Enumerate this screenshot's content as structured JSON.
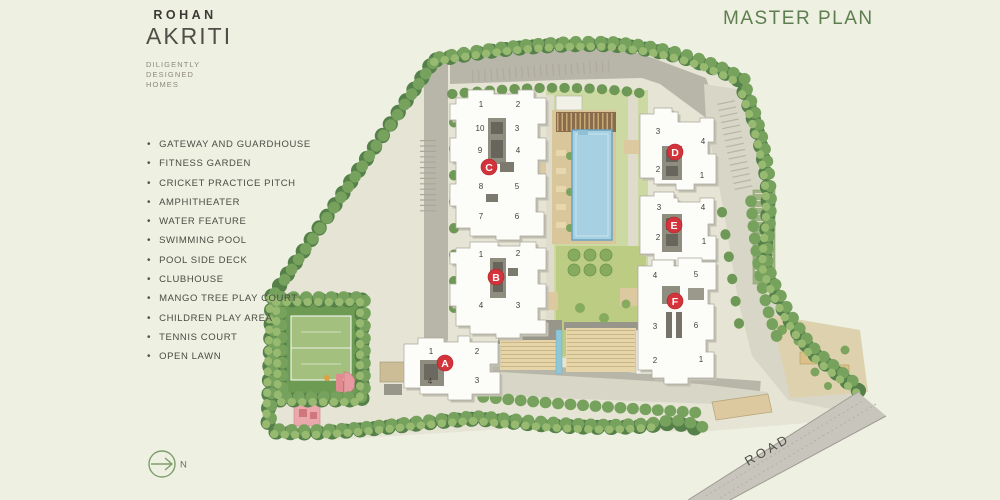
{
  "brand": {
    "name": "ROHAN",
    "product": "AKRITI",
    "tagline_line1": "DILIGENTLY",
    "tagline_line2": "DESIGNED HOMES"
  },
  "header": {
    "title": "MASTER PLAN"
  },
  "amenities": {
    "items": [
      "GATEWAY AND GUARDHOUSE",
      "FITNESS GARDEN",
      "CRICKET PRACTICE PITCH",
      "AMPHITHEATER",
      "WATER FEATURE",
      "SWIMMING POOL",
      "POOL SIDE DECK",
      "CLUBHOUSE",
      "MANGO TREE PLAY COURT",
      "CHILDREN PLAY AREA",
      "TENNIS COURT",
      "OPEN LAWN"
    ]
  },
  "compass": {
    "north_label": "N"
  },
  "site_plan": {
    "road_label": "ROAD",
    "towers": [
      {
        "id": "A",
        "units": [
          "1",
          "2",
          "4",
          "3"
        ]
      },
      {
        "id": "B",
        "units": [
          "1",
          "2",
          "4",
          "3"
        ]
      },
      {
        "id": "C",
        "units": [
          "1",
          "2",
          "10",
          "3",
          "9",
          "4",
          "8",
          "5",
          "7",
          "6"
        ]
      },
      {
        "id": "D",
        "units": [
          "3",
          "4",
          "2",
          "1"
        ]
      },
      {
        "id": "E",
        "units": [
          "3",
          "4",
          "2",
          "1"
        ]
      },
      {
        "id": "F",
        "units": [
          "4",
          "5",
          "3",
          "6",
          "2",
          "1"
        ]
      }
    ],
    "colors": {
      "marker_red": "#d3333a",
      "title_green": "#5e7e50",
      "pool_blue": "#a7d0e3",
      "lawn_green": "#bccd83"
    }
  }
}
